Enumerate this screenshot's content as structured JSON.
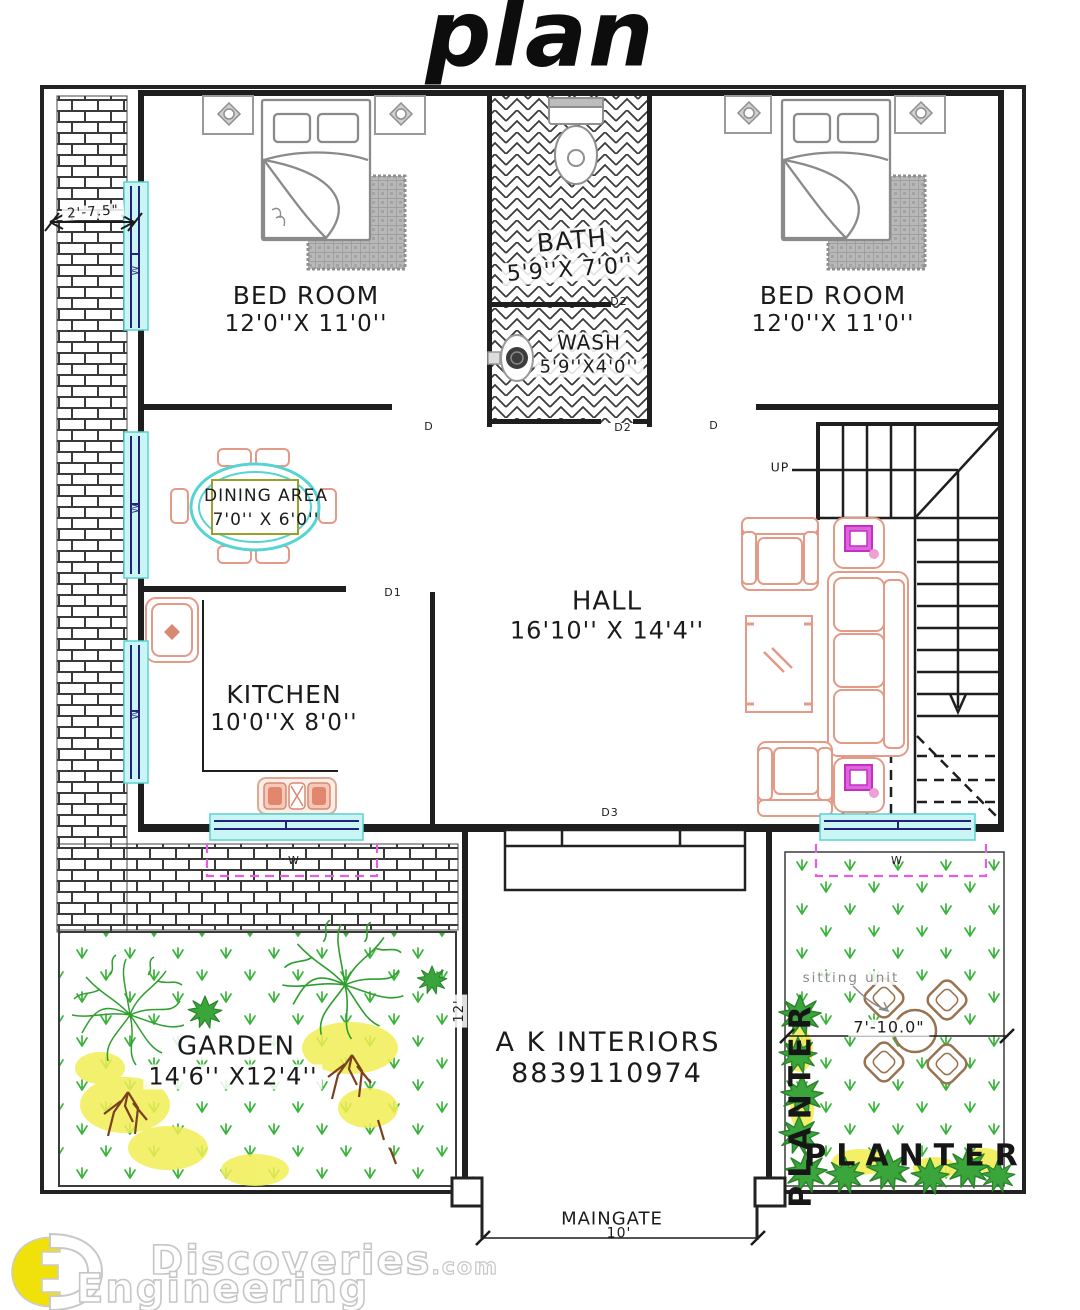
{
  "title": "plan",
  "rooms": {
    "bedroom_left": {
      "name": "BED ROOM",
      "dim": "12'0''X 11'0''"
    },
    "bath": {
      "name": "BATH",
      "dim": "5'9''X 7'0''"
    },
    "wash": {
      "name": "WASH",
      "dim": "5'9''X4'0''"
    },
    "bedroom_right": {
      "name": "BED ROOM",
      "dim": "12'0''X 11'0''"
    },
    "dining": {
      "name": "DINING AREA",
      "dim": "7'0'' X 6'0''"
    },
    "kitchen": {
      "name": "KITCHEN",
      "dim": "10'0''X 8'0''"
    },
    "hall": {
      "name": "HALL",
      "dim": "16'10'' X 14'4''"
    },
    "garden": {
      "name": "GARDEN",
      "dim": "14'6'' X12'4''"
    }
  },
  "doors": {
    "d": "D",
    "d1": "D1",
    "d2": "D2",
    "d3": "D3"
  },
  "window_label": "W",
  "stairs": {
    "up": "UP"
  },
  "outdoor": {
    "sitting_unit": "sitting unit",
    "planter": "PLANTER",
    "maingate": "MAINGATE"
  },
  "dims": {
    "side_passage": "2'-7.5\"",
    "garden_depth": "12'",
    "sitting": "7'-10.0\"",
    "gate_width": "10'"
  },
  "branding": {
    "company": "A K INTERIORS",
    "phone": "8839110974"
  },
  "watermark": {
    "site": "Discoveries",
    "tld": ".com",
    "word2": "Engineering"
  },
  "colors": {
    "wall": "#1e1e1e",
    "furniture_salmon": "#e39a86",
    "window_fill": "#c9f5f5",
    "window_line": "#23237d",
    "accent_magenta": "#cf3ecf",
    "grass_green": "#3cb43c",
    "tree_green": "#2f9e2f",
    "flower_yellow": "#f2ee55",
    "dining_cyan": "#54d4d4",
    "dining_inner": "#9aa02c",
    "sitting_brown": "#99734f",
    "gray_fixture": "#8a8a8a",
    "logo_yellow": "#f0e10a"
  }
}
